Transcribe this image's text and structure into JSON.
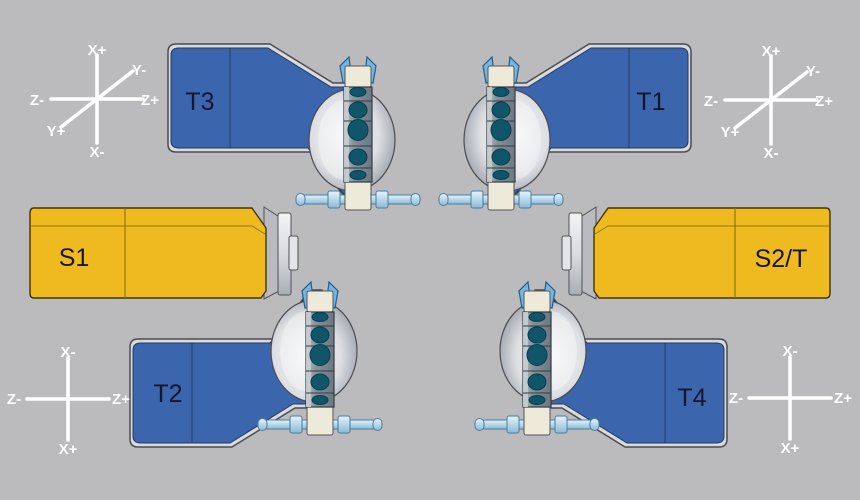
{
  "diagram": {
    "description": "machine tool working-area configuration with four turrets and two spindles"
  },
  "stations": {
    "t1": "T1",
    "t2": "T2",
    "t3": "T3",
    "t4": "T4",
    "s1": "S1",
    "s2t": "S2/T"
  },
  "axes": {
    "top_left": {
      "up": "X+",
      "down": "X-",
      "left": "Z-",
      "right": "Z+",
      "diag_up": "Y-",
      "diag_down": "Y+"
    },
    "top_right": {
      "up": "X+",
      "down": "X-",
      "left": "Z-",
      "right": "Z+",
      "diag_up": "Y-",
      "diag_down": "Y+"
    },
    "bottom_left": {
      "up": "X-",
      "down": "X+",
      "left": "Z-",
      "right": "Z+"
    },
    "bottom_right": {
      "up": "X-",
      "down": "X+",
      "left": "Z-",
      "right": "Z+"
    }
  },
  "colors": {
    "background": "#bbbbbd",
    "turret_blue": "#3b66ae",
    "spindle_yellow": "#eeba1f",
    "tool_pocket_teal": "#0f566a",
    "metal_silver": "#d9dadc",
    "holder_cream": "#edead9",
    "shaft_steel": "#badbed",
    "axis_white": "#ffffff"
  }
}
